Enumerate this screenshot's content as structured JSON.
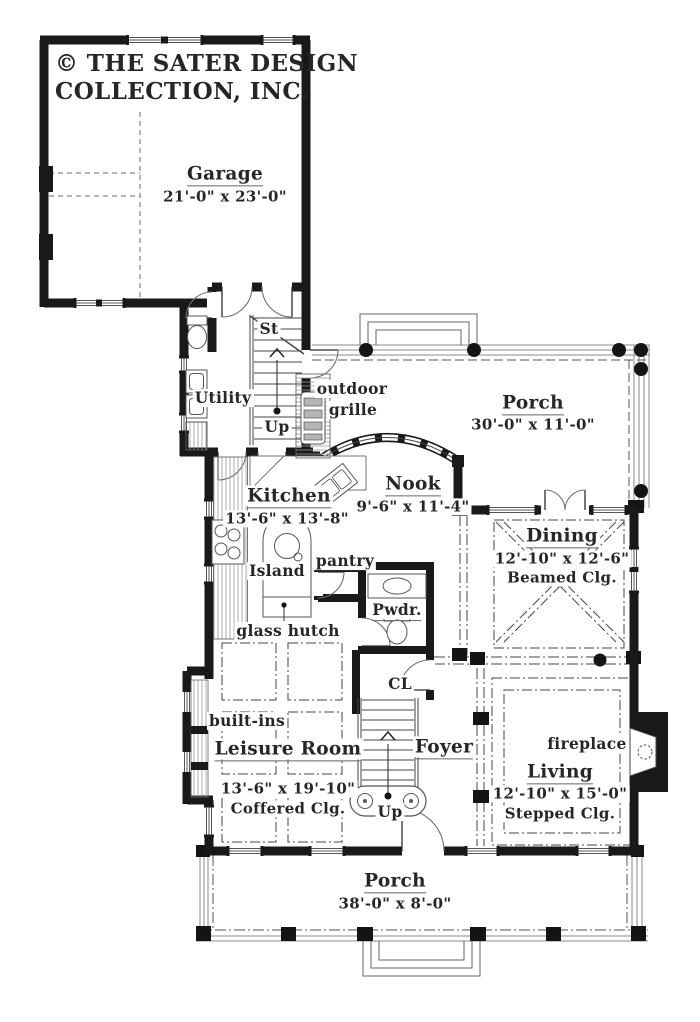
{
  "branding": {
    "line1": "© THE SATER DESIGN",
    "line2": "COLLECTION, INC."
  },
  "rooms": {
    "garage": {
      "name": "Garage",
      "dims": "21'-0\" x  23'-0\""
    },
    "porch_top": {
      "name": "Porch",
      "dims": "30'-0\" x 11'-0\""
    },
    "kitchen": {
      "name": "Kitchen",
      "dims": "13'-6\" x 13'-8\""
    },
    "nook": {
      "name": "Nook",
      "dims": "9'-6\" x 11'-4\""
    },
    "dining": {
      "name": "Dining",
      "dims": "12'-10\" x 12'-6\"",
      "ceiling": "Beamed Clg."
    },
    "leisure": {
      "name": "Leisure Room",
      "dims": "13'-6\" x  19'-10\"",
      "ceiling": "Coffered Clg."
    },
    "living": {
      "name": "Living",
      "dims": "12'-10\" x 15'-0\"",
      "ceiling": "Stepped Clg."
    },
    "foyer": {
      "name": "Foyer"
    },
    "utility": {
      "name": "Utility"
    },
    "powder": {
      "name": "Pwdr."
    },
    "porch_bottom": {
      "name": "Porch",
      "dims": "38'-0\" x 8'-0\""
    }
  },
  "labels": {
    "stairs_st": "St",
    "up_back": "Up",
    "up_front": "Up",
    "outdoor_grille_line1": "outdoor",
    "outdoor_grille_line2": "grille",
    "island": "Island",
    "pantry": "pantry",
    "glass_hutch": "glass hutch",
    "closet": "CL",
    "built_ins": "built-ins",
    "fireplace": "fireplace"
  },
  "colors": {
    "wall": "#191919",
    "thin_line": "#777777",
    "text": "#262626"
  }
}
